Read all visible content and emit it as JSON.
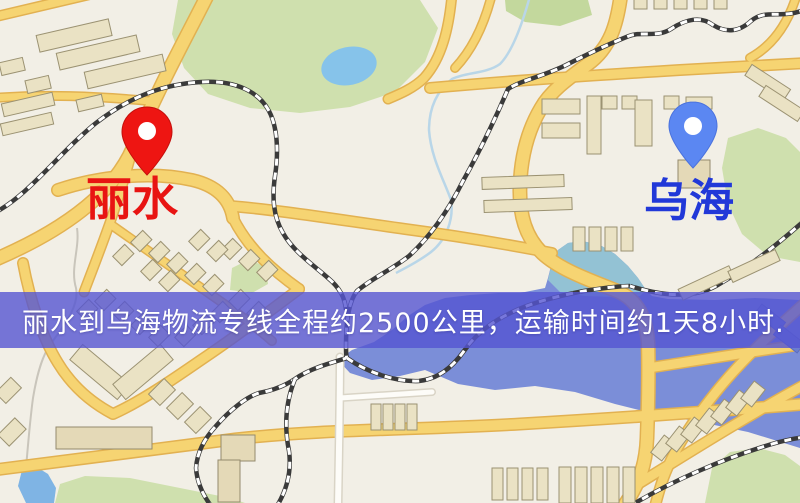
{
  "map": {
    "origin": {
      "label": "丽水",
      "label_color": "#e81412",
      "pin_color": "#ee1512"
    },
    "destination": {
      "label": "乌海",
      "label_color": "#2138d8",
      "pin_color": "#5b87f2"
    },
    "banner": {
      "text": "丽水到乌海物流专线全程约2500公里，运输时间约1天8小时.",
      "background": "#5555d2",
      "text_color": "#ffffff"
    },
    "colors": {
      "land": "#f2efe6",
      "road": "#f6d472",
      "park": "#cfe0ae",
      "water": "#7b8ed8",
      "lake": "#86c3ea",
      "railway": "#3a3a3a",
      "building": "#eae2c4"
    }
  }
}
